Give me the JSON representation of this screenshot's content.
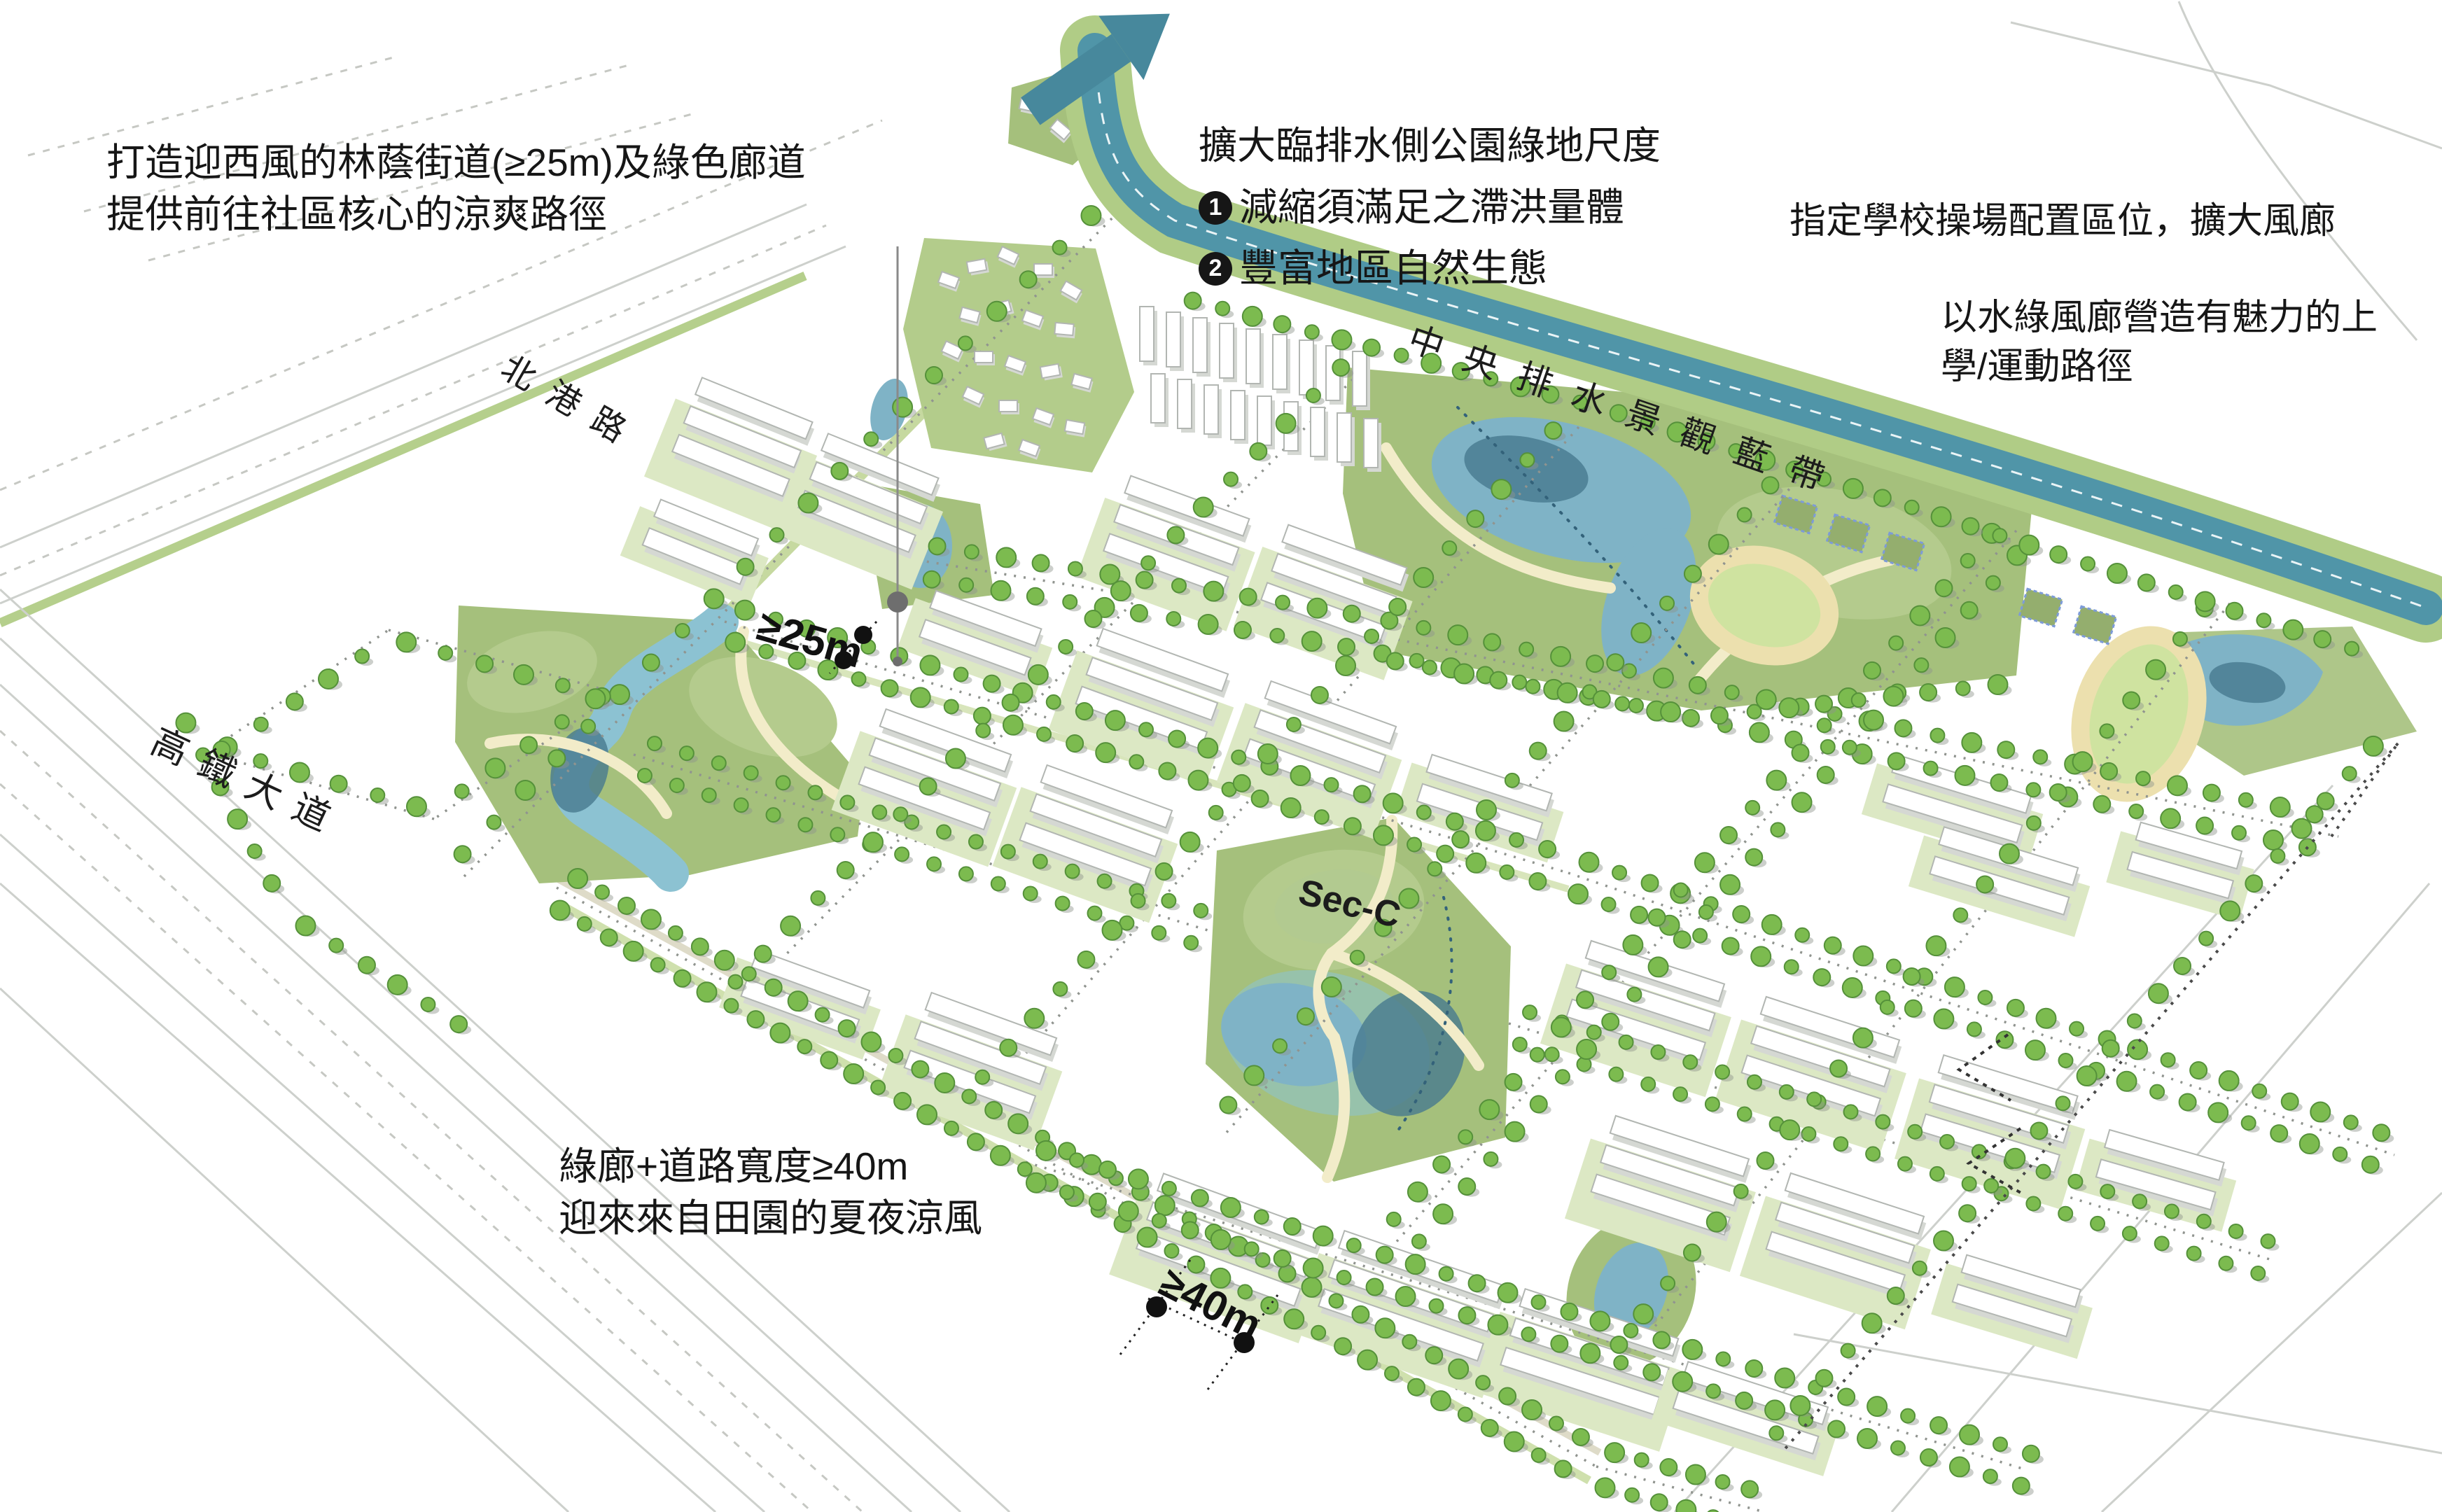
{
  "annotations": {
    "northwest": {
      "line1": "打造迎西風的林蔭街道(≥25m)及綠色廊道",
      "line2": "提供前往社區核心的涼爽路徑"
    },
    "north": {
      "title": "擴大臨排水側公園綠地尺度",
      "item1_num": "1",
      "item1_text": "減縮須滿足之滯洪量體",
      "item2_num": "2",
      "item2_text": "豐富地區自然生態"
    },
    "northeast": {
      "text": "指定學校操場配置區位，擴大風廊"
    },
    "east": {
      "line1": "以水綠風廊營造有魅力的上",
      "line2": "學/運動路徑"
    },
    "southwest": {
      "line1": "綠廊+道路寬度≥40m",
      "line2": "迎來來自田園的夏夜涼風"
    }
  },
  "map_labels": {
    "road_north": "北港路",
    "road_southwest": "高鐵大道",
    "waterway": "中央排水景觀藍帶",
    "park_section": "Sec-C",
    "dim_street": "≥25m",
    "dim_boulevard": "≥40m"
  },
  "icons": {
    "flow-arrow-icon": "bent teal arrow pointing northeast (drainage outflow direction)"
  },
  "colors": {
    "channel_teal": "#5095a8",
    "arrow_teal": "#47889c",
    "bank_green": "#b0cc86",
    "park_green": "#a5c07c",
    "pond_blue": "#7fb3c6",
    "pond_deep": "#47798e",
    "path_cream": "#f2ecc9",
    "tree_green": "#7cbb4f",
    "text_dark": "#161616"
  }
}
